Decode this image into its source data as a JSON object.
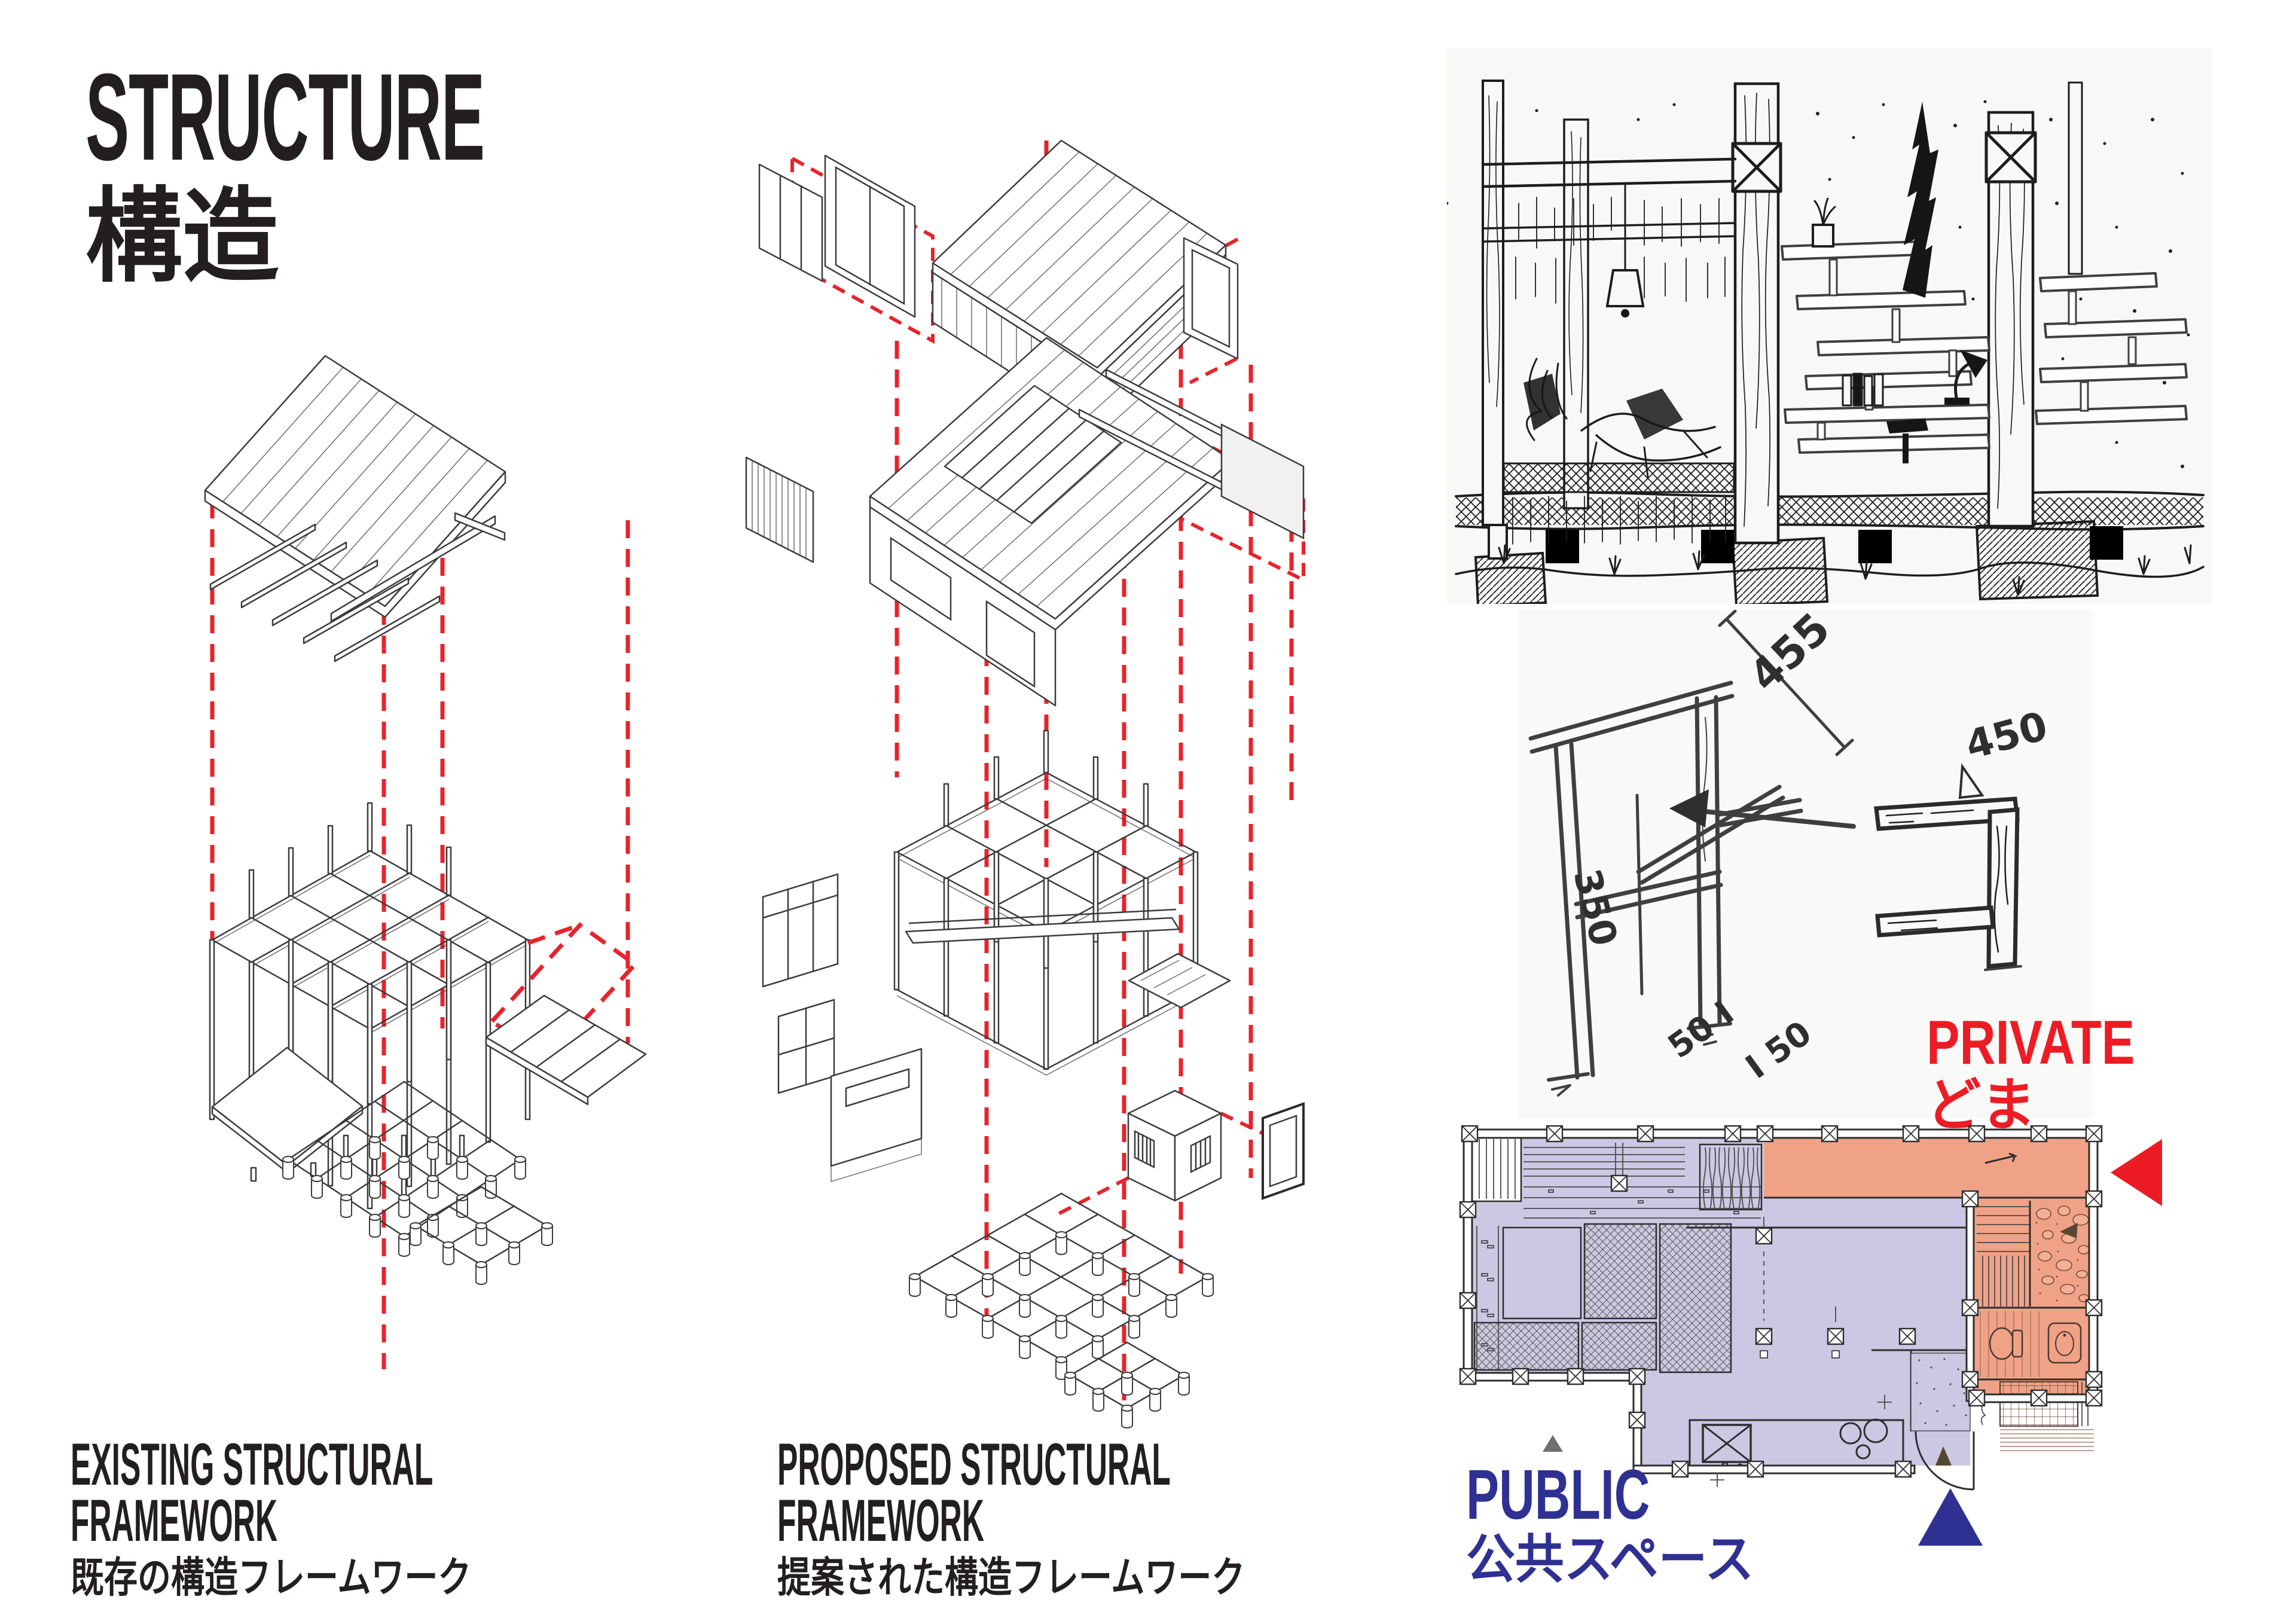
{
  "title": {
    "en": "STRUCTURE",
    "jp": "構造"
  },
  "captions": {
    "existing": {
      "line1": "EXISTING STRUCTURAL",
      "line2": "FRAMEWORK",
      "jp": "既存の構造フレームワーク"
    },
    "proposed": {
      "line1": "PROPOSED STRUCTURAL",
      "line2": "FRAMEWORK",
      "jp": "提案された構造フレームワーク"
    }
  },
  "legend": {
    "private": {
      "en": "PRIVATE",
      "jp": "どま",
      "color": "#ed1c24"
    },
    "public": {
      "en": "PUBLIC",
      "jp": "公共スペース",
      "color": "#2e3192"
    }
  },
  "sketch_notes": {
    "dim_455": "455",
    "dim_450": "450",
    "dim_350": "350",
    "note_a": "50 I",
    "note_b": "I 50"
  },
  "colors": {
    "accent_red": "#ed1c24",
    "accent_blue": "#2e3192",
    "dash_red": "#e8232b",
    "public_fill": "#cbc8e3",
    "private_fill": "#f0a287",
    "ink": "#231f20",
    "pencil": "#6a6a6a"
  }
}
